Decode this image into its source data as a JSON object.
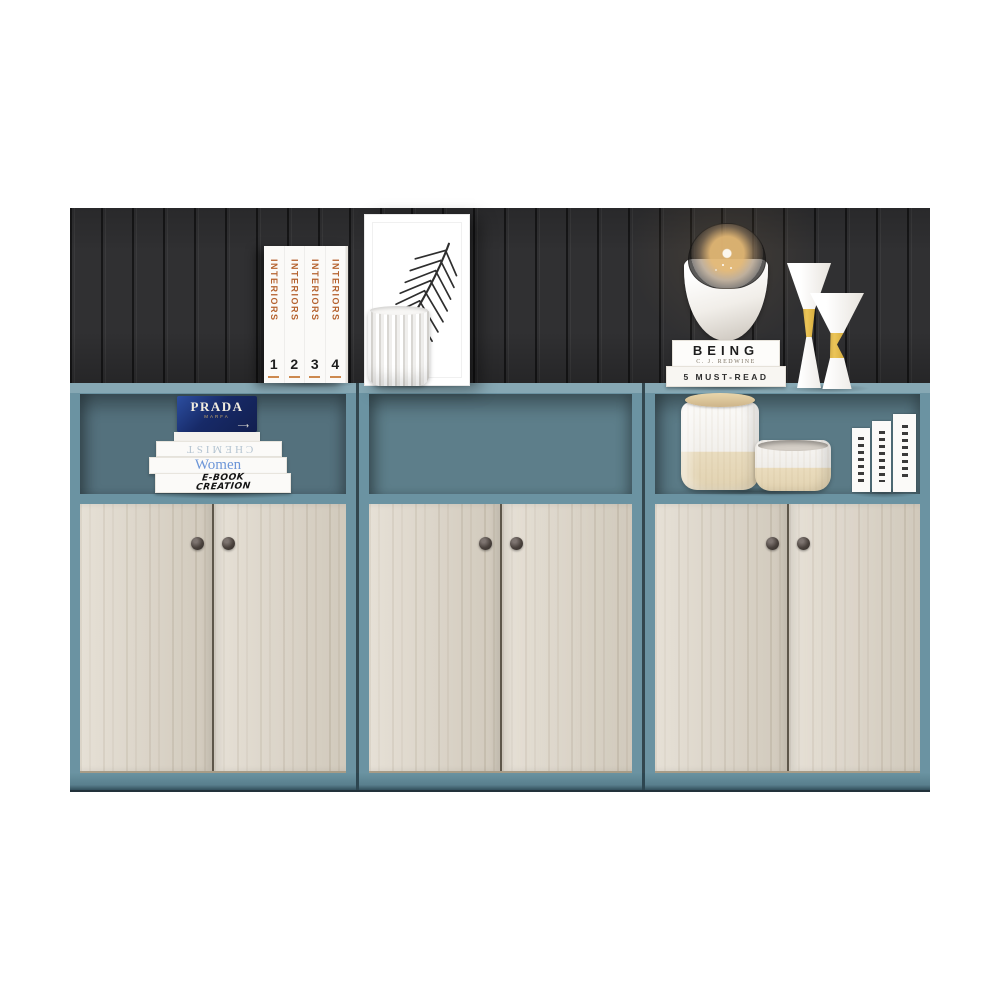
{
  "colors": {
    "background": "#ffffff",
    "wall_panel": "#303032",
    "cabinet_teal": "#6b93a2",
    "niche_interior": "#5d7e8a",
    "door_wood": "#dcd4c6",
    "plinth_teal": "#5f8a99",
    "prada_blue": "#1d2f73",
    "interiors_orange": "#b5622f",
    "gold_accent": "#d9a82c"
  },
  "decor": {
    "interiors_set": {
      "spine_title": "INTERIORS",
      "volumes": [
        "1",
        "2",
        "3",
        "4"
      ]
    },
    "prada_book": {
      "title": "PRADA",
      "subtitle": "MARFA",
      "arrow": "⟶"
    },
    "book_stack": {
      "top_title": "CHEMIST",
      "middle_title": "Women",
      "bottom_line1": "E-BOOK",
      "bottom_line2": "CREATION"
    },
    "lamp_books": {
      "title": "BEING",
      "author": "C. J. REDWINE",
      "second_title": "5 MUST-READ"
    }
  }
}
